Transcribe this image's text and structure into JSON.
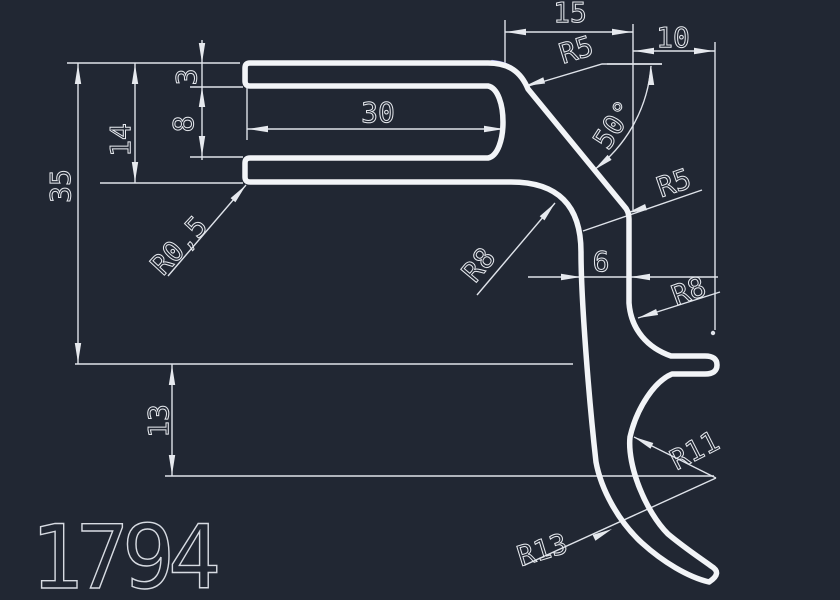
{
  "canvas": {
    "width": 840,
    "height": 600,
    "background": "#212733"
  },
  "colors": {
    "geometry_line": "#f2f4f7",
    "dimension_line": "#dfe3ea",
    "highlight_blue": "#767cd2"
  },
  "part_label": "1794",
  "dimensions": {
    "width_30": "30",
    "width_15": "15",
    "width_10": "10",
    "width_6": "6",
    "height_3": "3",
    "height_8": "8",
    "height_14": "14",
    "height_35": "35",
    "height_13": "13",
    "angle_50": "50°",
    "radius_r5_top": "R5",
    "radius_r5_side": "R5",
    "radius_r05": "R0,5",
    "radius_r8_web": "R8",
    "radius_r8_leg": "R8",
    "radius_r11": "R11",
    "radius_r13": "R13"
  }
}
